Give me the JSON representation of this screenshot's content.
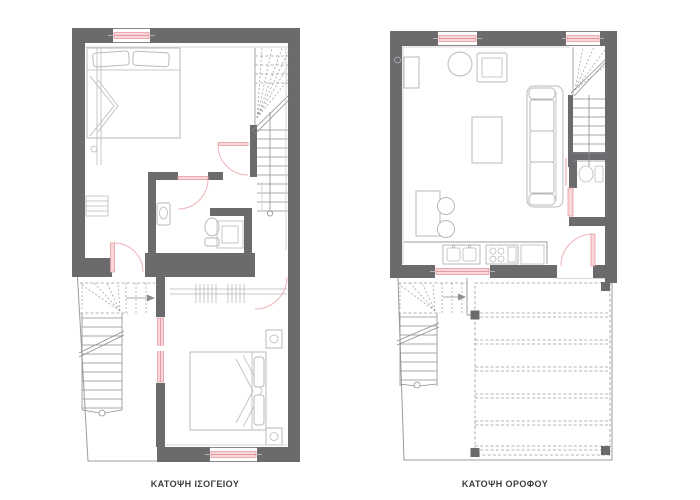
{
  "titles": {
    "ground_floor": "ΚΑΤΟΨΗ ΙΣΟΓΕΙΟΥ",
    "upper_floor": "ΚΑΤΟΨΗ ΟΡΟΦΟΥ"
  },
  "colors": {
    "background": "#ffffff",
    "wall": "#6b6b6e",
    "line": "#9c9ca0",
    "light_line": "#c9c9cd",
    "furniture": "#b9b9bd",
    "stair_line": "#8f8f93",
    "dash_line": "#9a9a9e",
    "pink_fill": "#f7d7d9",
    "pink_stroke": "#e59aa2",
    "pink_arc": "#eeb3b8",
    "text": "#3d3d3f"
  }
}
